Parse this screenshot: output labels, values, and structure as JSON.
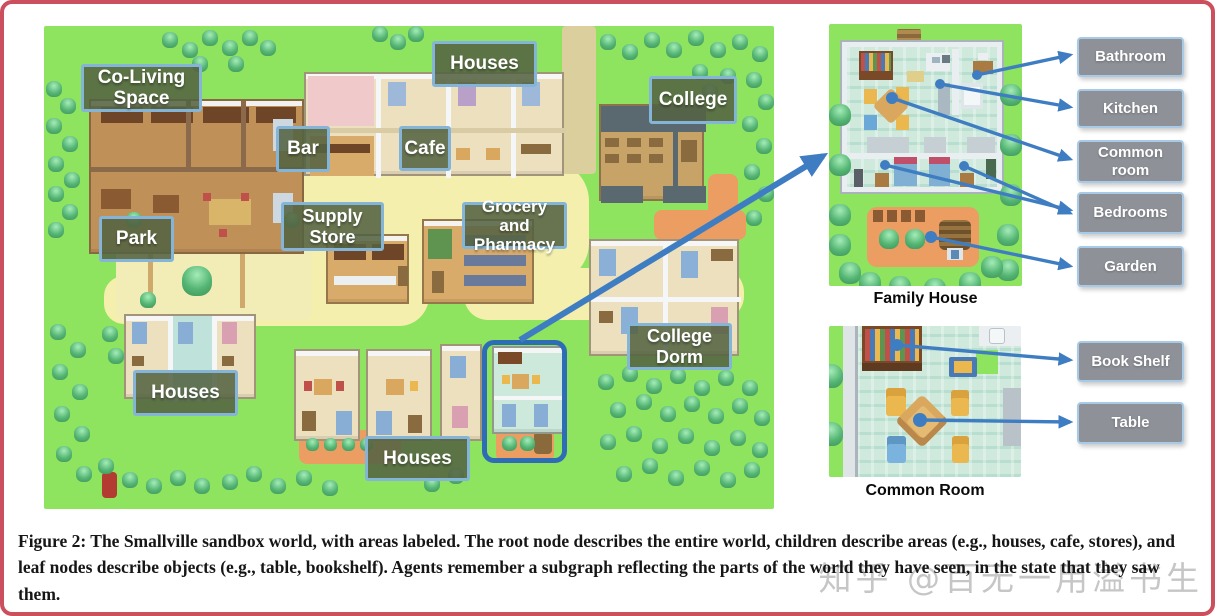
{
  "figure": {
    "number_label": "Figure 2:",
    "caption_body": "The Smallville sandbox world, with areas labeled. The root node describes the entire world, children describe areas (e.g., houses, cafe, stores), and leaf nodes describe objects (e.g., table, bookshelf). Agents remember a subgraph reflecting the parts of the world they have seen, in the state that they saw them.",
    "watermark": "知乎 @百无一用溢书生"
  },
  "map": {
    "name": "Smallville sandbox world map",
    "area_labels": [
      {
        "id": "co-living-space",
        "text": "Co-Living Space"
      },
      {
        "id": "houses-top",
        "text": "Houses"
      },
      {
        "id": "college",
        "text": "College"
      },
      {
        "id": "bar",
        "text": "Bar"
      },
      {
        "id": "cafe",
        "text": "Cafe"
      },
      {
        "id": "park",
        "text": "Park"
      },
      {
        "id": "supply-store",
        "text": "Supply Store"
      },
      {
        "id": "grocery-pharmacy",
        "text": "Grocery and Pharmacy"
      },
      {
        "id": "college-dorm",
        "text": "College Dorm"
      },
      {
        "id": "houses-left",
        "text": "Houses"
      },
      {
        "id": "houses-bottom",
        "text": "Houses"
      }
    ]
  },
  "family_house": {
    "caption": "Family House",
    "labels": [
      {
        "text": "Bathroom"
      },
      {
        "text": "Kitchen"
      },
      {
        "text": "Common room"
      },
      {
        "text": "Bedrooms"
      },
      {
        "text": "Garden"
      }
    ]
  },
  "common_room": {
    "caption": "Common Room",
    "labels": [
      {
        "text": "Book Shelf"
      },
      {
        "text": "Table"
      }
    ]
  },
  "colors": {
    "frame_red": "#cb4f5c",
    "arrow_blue": "#3f7dc2",
    "highlight_blue": "#2e6db6",
    "map_label_bg": "#546342",
    "map_label_border": "#84b5d8",
    "panel_label_bg": "#8e9298",
    "panel_label_border": "#a9cae6",
    "grass_green": "#8ee35f",
    "road_cream": "#f4efad"
  }
}
